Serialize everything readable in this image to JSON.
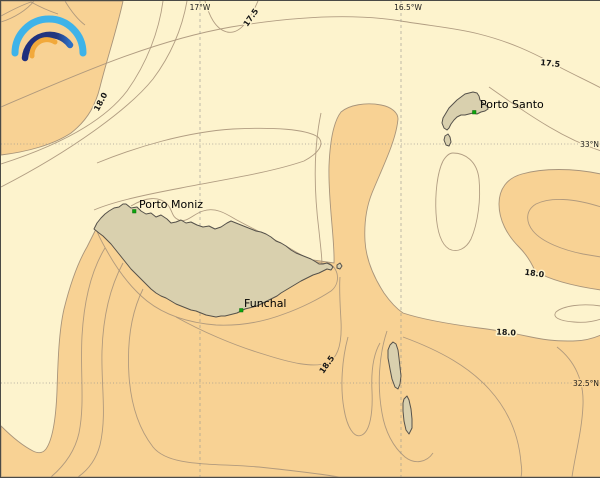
{
  "map": {
    "title": "sea-surface-temperature-contour-map-madeira",
    "grid": {
      "lon_labels": [
        {
          "text": "17°W"
        },
        {
          "text": "16.5°W"
        }
      ],
      "lat_labels": [
        {
          "text": "33°N"
        },
        {
          "text": "32.5°N"
        }
      ]
    },
    "contour_labels": [
      {
        "value": "17.5"
      },
      {
        "value": "17.5"
      },
      {
        "value": "18.0"
      },
      {
        "value": "18.0"
      },
      {
        "value": "18.0"
      },
      {
        "value": "18.5"
      }
    ],
    "places": {
      "porto_moniz": "Porto Moniz",
      "funchal": "Funchal",
      "porto_santo": "Porto Santo"
    },
    "colors": {
      "sea_low": "#fdf3cd",
      "sea_high": "#f8d294",
      "land": "#d9d0ae",
      "contour": "#a8947a",
      "coast": "#55514a",
      "marker": "#0ca50c",
      "grid": "#96948e",
      "logo_outer": "#3eb3e9",
      "logo_middle": "#24377e",
      "logo_middle_end": "#2d6fc4",
      "logo_inner": "#f2a93b"
    }
  }
}
